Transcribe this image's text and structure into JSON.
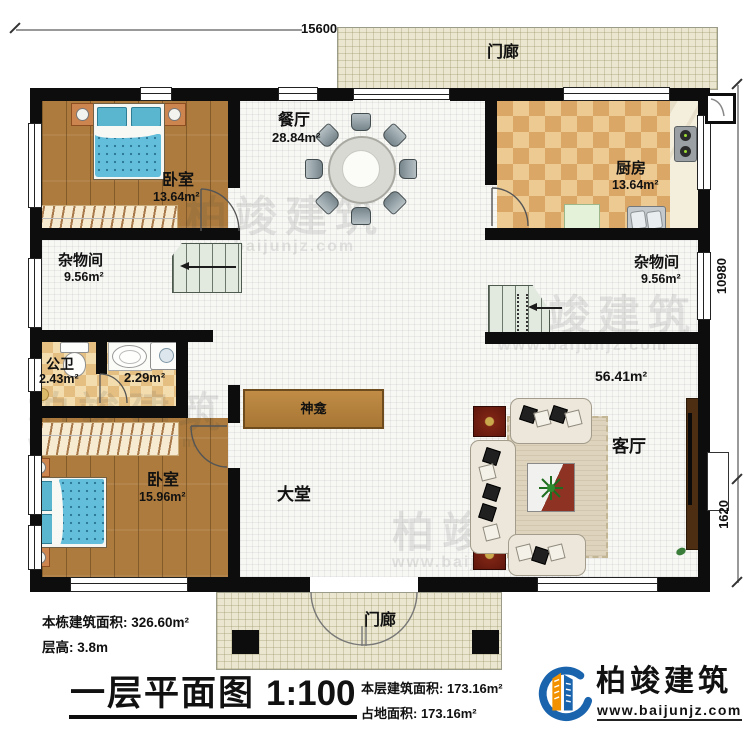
{
  "dims": {
    "top": "15600",
    "right_main": "10980",
    "right_porch": "1620"
  },
  "rooms": {
    "porch_top": {
      "label": "门廊"
    },
    "porch_bottom": {
      "label": "门廊"
    },
    "dining": {
      "label": "餐厅",
      "area": "28.84m²"
    },
    "kitchen": {
      "label": "厨房",
      "area": "13.64m²"
    },
    "bedroom_top": {
      "label": "卧室",
      "area": "13.64m²"
    },
    "bedroom_bottom": {
      "label": "卧室",
      "area": "15.96m²"
    },
    "storage_left": {
      "label": "杂物间",
      "area": "9.56m²"
    },
    "storage_right": {
      "label": "杂物间",
      "area": "9.56m²"
    },
    "bathroom": {
      "label": "公卫",
      "area": "2.43m²"
    },
    "washroom": {
      "area": "2.29m²"
    },
    "shrine": {
      "label": "神龛"
    },
    "hall": {
      "label": "大堂"
    },
    "living": {
      "label": "客厅",
      "area": "56.41m²"
    }
  },
  "notes": {
    "building_area": "本栋建筑面积: 326.60m²",
    "floor_height": "层高: 3.8m"
  },
  "titleblock": {
    "title": "一层平面图",
    "scale": "1:100",
    "floor_area": "本层建筑面积: 173.16m²",
    "footprint": "占地面积: 173.16m²"
  },
  "brand": {
    "name": "柏竣建筑",
    "site": "www.baijunjz.com"
  },
  "watermark": {
    "name": "柏竣建筑",
    "site": "www.baijunjz.com"
  }
}
